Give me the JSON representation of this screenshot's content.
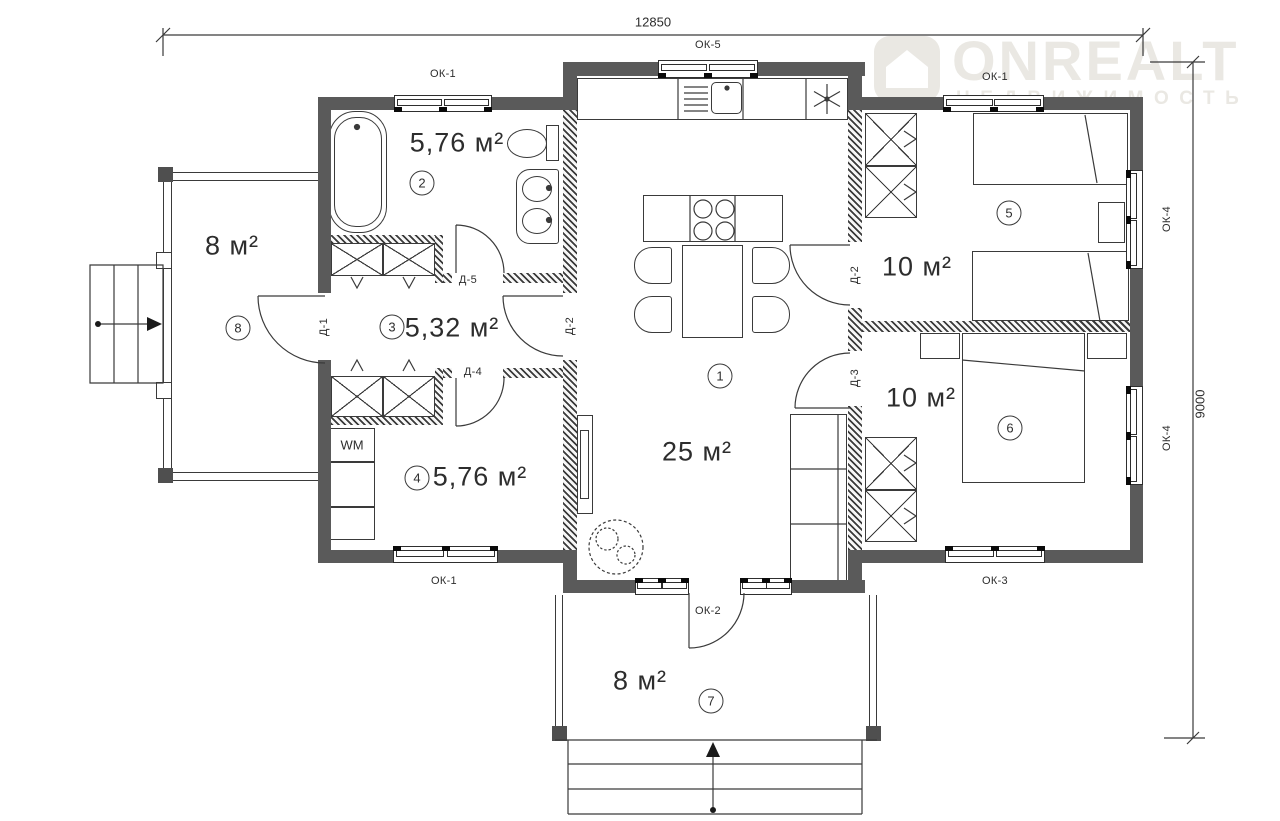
{
  "watermark": {
    "brand": "ONREALT",
    "subtitle": "НЕДВИЖИМОСТЬ"
  },
  "dimensions": {
    "width": "12850",
    "depth": "9000"
  },
  "rooms": {
    "living": {
      "number": "1",
      "area": "25 м²"
    },
    "bathroom": {
      "number": "2",
      "area": "5,76 м²"
    },
    "hall": {
      "number": "3",
      "area": "5,32 м²"
    },
    "laundry": {
      "number": "4",
      "area": "5,76 м²"
    },
    "bedroom_top": {
      "number": "5",
      "area": "10 м²"
    },
    "bedroom_bottom": {
      "number": "6",
      "area": "10 м²"
    },
    "porch_front": {
      "number": "7",
      "area": "8 м²"
    },
    "porch_side": {
      "number": "8",
      "area": "8 м²"
    }
  },
  "labels": {
    "ok1_top_left": "ОК-1",
    "ok5_top": "ОК-5",
    "ok1_top_right": "ОК-1",
    "ok4_right_upper": "ОК-4",
    "ok4_right_lower": "ОК-4",
    "ok1_bottom_left": "ОК-1",
    "ok3_bottom_right": "ОК-3",
    "ok2_porch_door": "ОК-2",
    "d1": "Д-1",
    "d2_hall": "Д-2",
    "d2_bedroom": "Д-2",
    "d3": "Д-3",
    "d4": "Д-4",
    "d5": "Д-5",
    "washing_machine": "WM"
  },
  "colors": {
    "wall": "#5a5a5a",
    "line": "#3a3a3a",
    "watermark": "#eae8e3"
  }
}
